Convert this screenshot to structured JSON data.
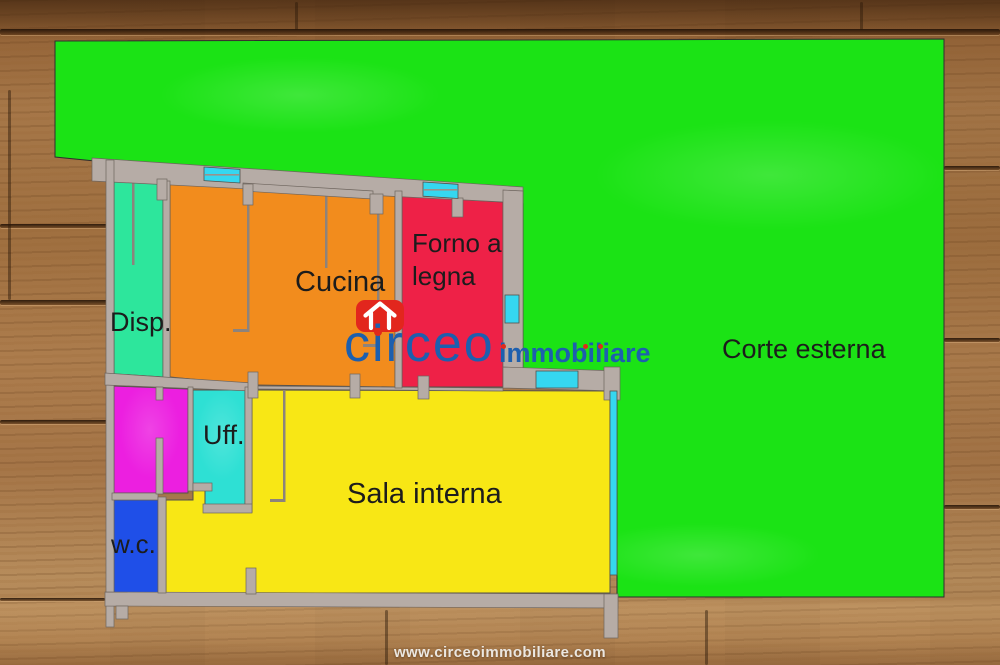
{
  "plan": {
    "rooms": [
      {
        "id": "corte-esterna",
        "label": "Corte esterna",
        "color": "#1be315"
      },
      {
        "id": "cucina",
        "label": "Cucina",
        "color": "#f28c1d"
      },
      {
        "id": "forno-a-legna",
        "label": "Forno a legna",
        "color": "#ee2147"
      },
      {
        "id": "dispensa",
        "label": "Disp.",
        "color": "#2de69c"
      },
      {
        "id": "ufficio",
        "label": "Uff.",
        "color": "#2ee0d4"
      },
      {
        "id": "bagno",
        "label": "w.c.",
        "color": "#1f4fe8"
      },
      {
        "id": "sala-interna",
        "label": "Sala interna",
        "color": "#f8e715"
      },
      {
        "id": "locale-rosa",
        "label": "",
        "color": "#ec1fe0"
      }
    ],
    "structure": {
      "wall_color": "#b6aca6",
      "wall_edge_color": "#6e655e",
      "thin_wall_color": "#8d837c",
      "window_color": "#35d7f0",
      "label_color": "#1c1c1c"
    }
  },
  "logo": {
    "brand": "circeo",
    "brand_suffix": "immobiliare",
    "brand_color": "#1d5fae",
    "icon_color": "#e2261d",
    "dot_color": "#e02a1c"
  },
  "footer": {
    "url": "www.circeoimmobiliare.com"
  }
}
